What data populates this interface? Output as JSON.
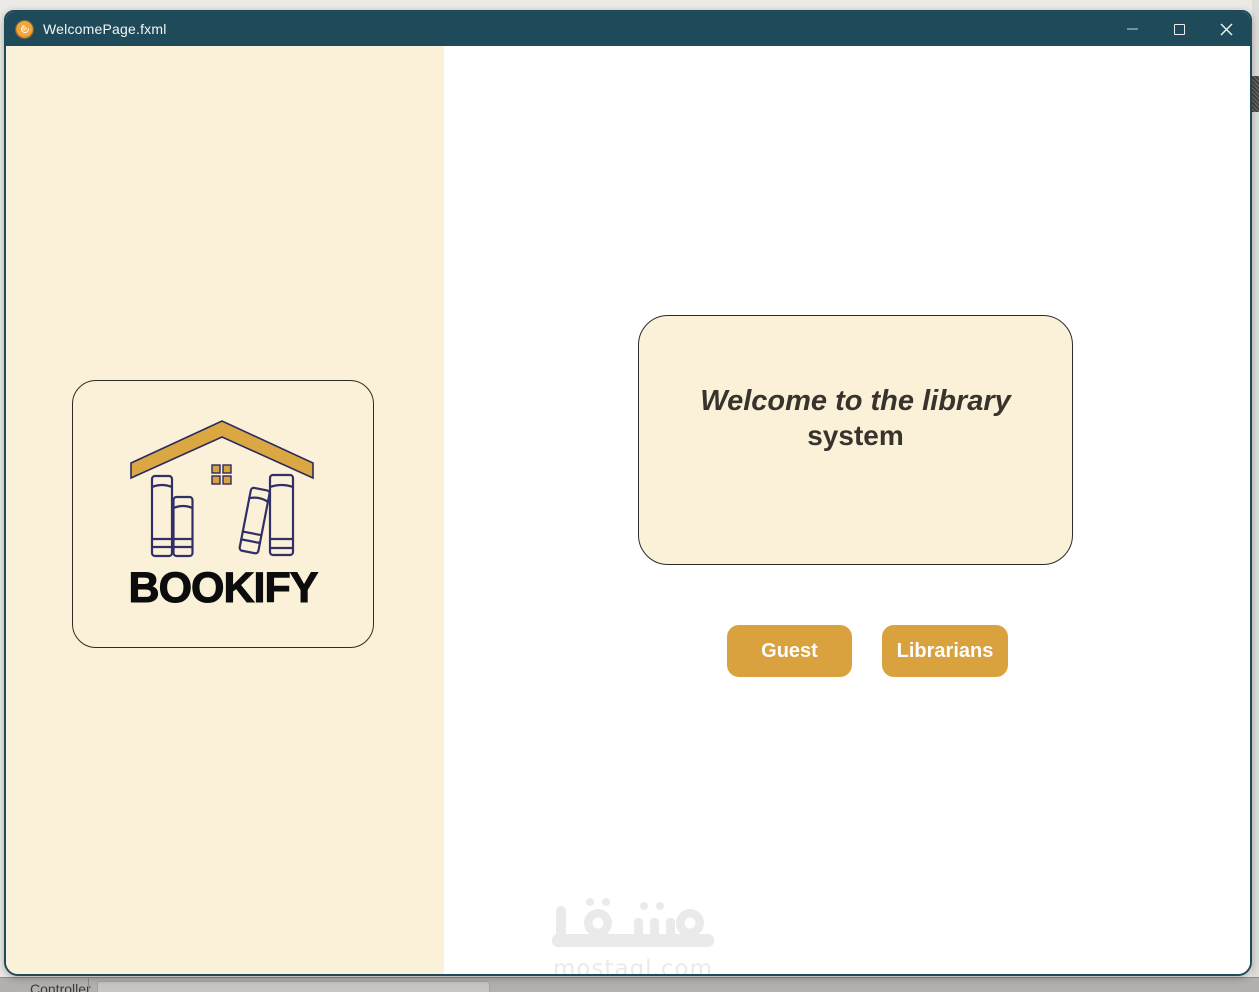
{
  "window": {
    "title": "WelcomePage.fxml",
    "controls": {
      "minimize": "minimize",
      "maximize": "maximize",
      "close": "close"
    }
  },
  "colors": {
    "titlebar_teal": "#1e4a5a",
    "cream": "#faf1d8",
    "accent_gold": "#d9a23f",
    "book_outline_navy": "#2b2a5e",
    "welcome_text": "#38332d",
    "watermark_gray": "#eaeaea"
  },
  "sidebar": {
    "brand": "BOOKIFY"
  },
  "main": {
    "welcome": {
      "line1": "Welcome to the library",
      "line2": "system"
    },
    "buttons": [
      {
        "label": "Guest"
      },
      {
        "label": "Librarians"
      }
    ]
  },
  "watermark": {
    "arabic": "مستقل",
    "domain": "mostaql.com"
  },
  "background_app": {
    "controller_label": "Controller"
  }
}
